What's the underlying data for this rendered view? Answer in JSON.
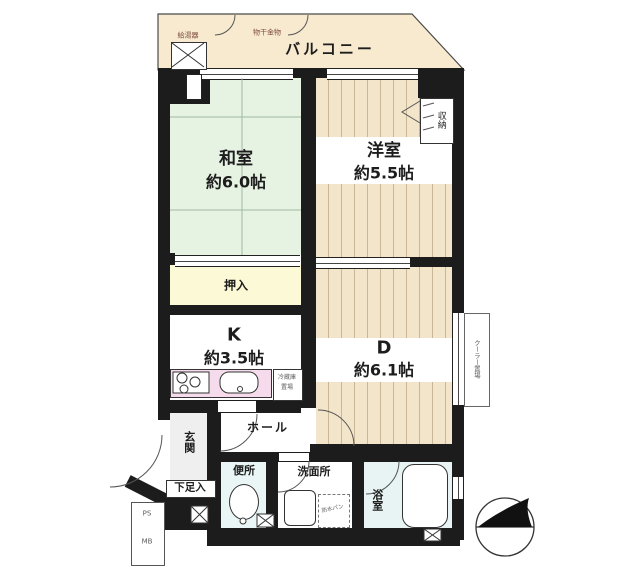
{
  "title": "間取り図",
  "balcony": {
    "label": "バルコニー",
    "water_heater": "給湯器",
    "laundry_hook": "物干金物"
  },
  "rooms": {
    "washitsu": {
      "name": "和室",
      "size": "約6.0帖"
    },
    "youshitsu": {
      "name": "洋室",
      "size": "約5.5帖"
    },
    "kitchen": {
      "name": "K",
      "size": "約3.5帖"
    },
    "dining": {
      "name": "D",
      "size": "約6.1帖"
    }
  },
  "spaces": {
    "oshiire": "押入",
    "shuno": "収納",
    "hall": "ホール",
    "genkan": "玄関",
    "gesokuire": "下足入",
    "benjo": "便所",
    "senmenjo": "洗面所",
    "yokushitsu": "浴室"
  },
  "fixtures": {
    "fridge_line1": "冷蔵庫",
    "fridge_line2": "置場",
    "cooler": "クーラー置場",
    "bousui_pan": "防水パン",
    "ps": "PS",
    "mb": "MB"
  },
  "colors": {
    "wall": "#1c1c1c",
    "tatami_green": "#e7f3e2",
    "wood_beige": "#f3e5c9",
    "plank_line": "#c9b795",
    "closet_yellow": "#fcf9d6",
    "counter_pink": "#f5dbec",
    "wet_area_blue": "#e8f4f3",
    "balcony_beige": "#f8eacf",
    "annotation_red": "#7b4a42"
  }
}
